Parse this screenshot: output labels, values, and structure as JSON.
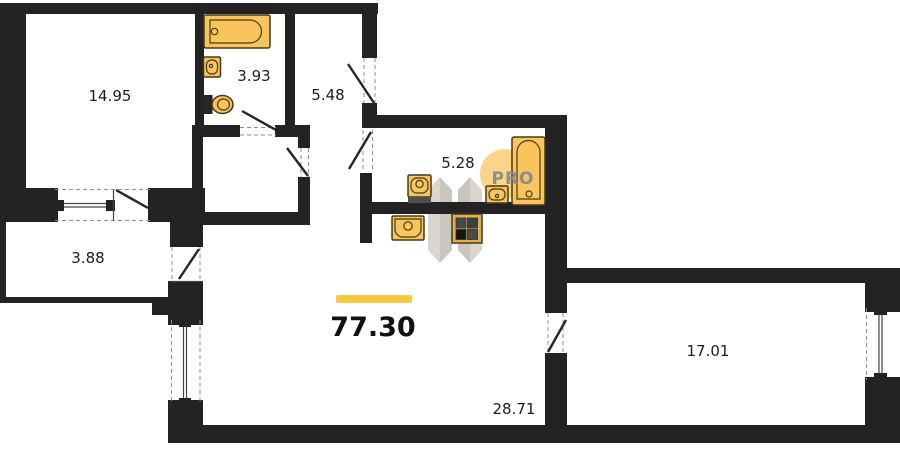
{
  "plan": {
    "total_area": "77.30",
    "watermark_text": "PRO",
    "rooms": [
      {
        "name": "bedroom-top-left",
        "area": "14.95"
      },
      {
        "name": "bathroom-small",
        "area": "3.93"
      },
      {
        "name": "entry-hall",
        "area": "5.48"
      },
      {
        "name": "bathroom-main",
        "area": "5.28"
      },
      {
        "name": "balcony",
        "area": "3.88"
      },
      {
        "name": "kitchen-living-area",
        "area": "28.71"
      },
      {
        "name": "bedroom-right",
        "area": "17.01"
      }
    ],
    "fixtures": [
      "bathtub-horizontal",
      "washbasin-small",
      "toilet",
      "washbasin",
      "washbasin-small",
      "bathtub-vertical",
      "kitchen-sink",
      "stove-4-burner"
    ],
    "colors": {
      "wall": "#232323",
      "fixture": "#F9C45C",
      "accent_bar": "#F7C843",
      "watermark_text": "#8d8d8d",
      "watermark_circle": "#FBCC74"
    }
  }
}
